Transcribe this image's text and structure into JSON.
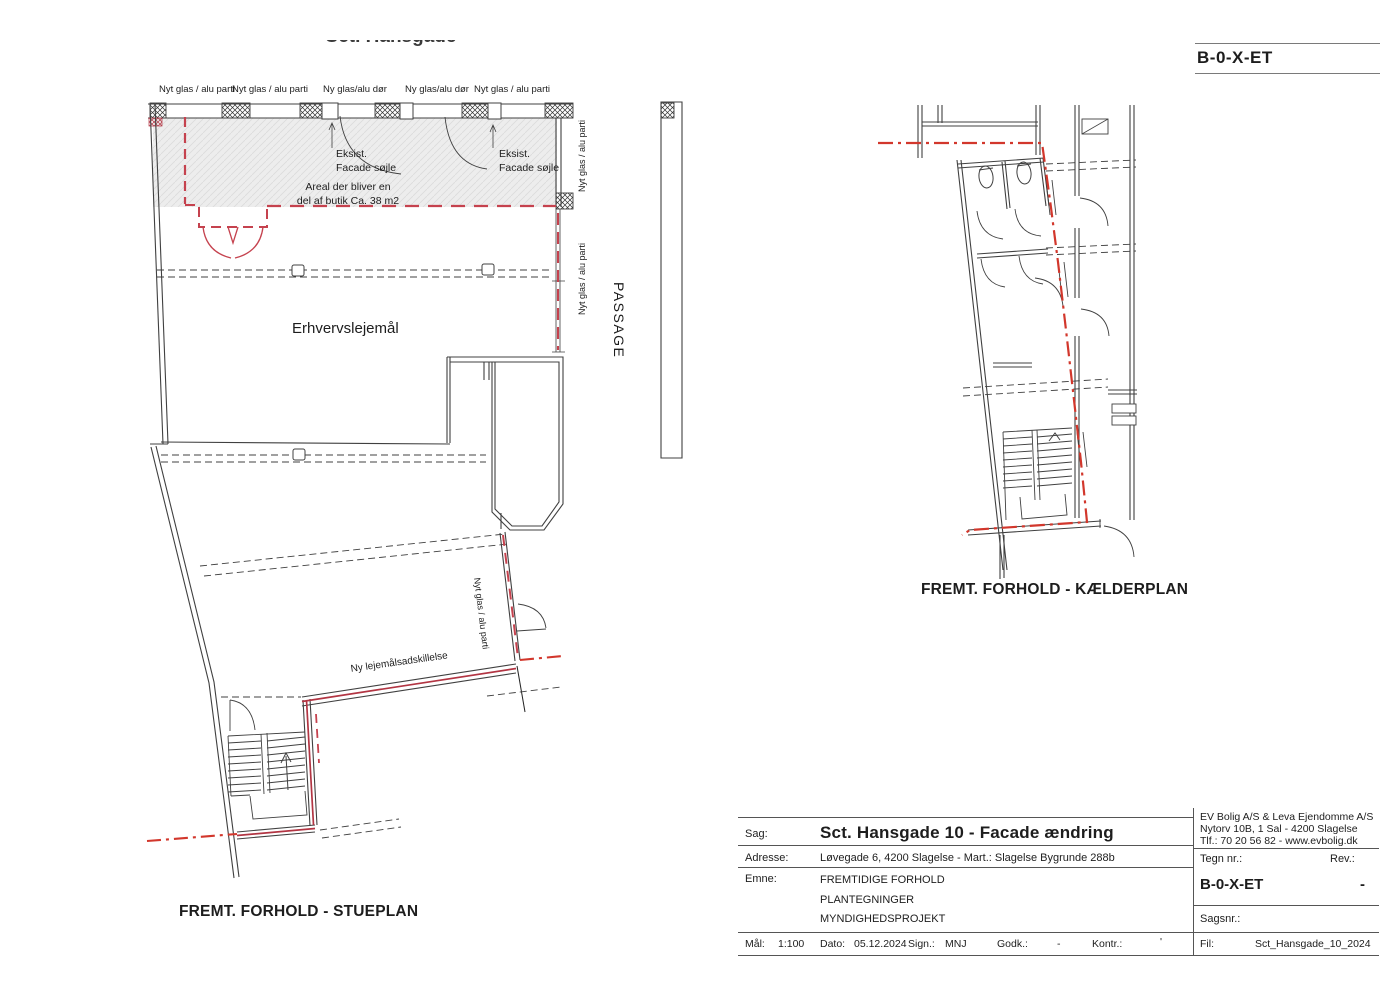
{
  "header": {
    "sheet_code": "B-0-X-ET"
  },
  "stueplan": {
    "title": "FREMT. FORHOLD - STUEPLAN",
    "street_label": "Sct. Hansgade",
    "passage_label": "PASSAGE",
    "facade_labels": [
      "Nyt glas / alu parti",
      "Nyt glas / alu parti",
      "Ny glas/alu dør",
      "Ny glas/alu dør",
      "Nyt glas / alu parti"
    ],
    "existing_column_note": "Eksist.\nFacade søjle",
    "shop_area_note": "Areal der bliver en\ndel af butik Ca. 38 m2",
    "room_label": "Erhvervslejemål",
    "side_glass_label": "Nyt glas / alu parti",
    "tilted_glass_label": "Nyt glas / alu parti",
    "partition_label": "Ny lejemålsadskillelse"
  },
  "kaelderplan": {
    "title": "FREMT. FORHOLD - KÆLDERPLAN"
  },
  "title_block": {
    "company_lines": [
      "EV Bolig A/S & Leva Ejendomme A/S",
      "Nytorv 10B, 1 Sal - 4200 Slagelse",
      "Tlf.: 70 20 56 82 - www.evbolig.dk"
    ],
    "sag_label": "Sag:",
    "sag_value": "Sct. Hansgade 10 - Facade ændring",
    "adresse_label": "Adresse:",
    "adresse_value": "Løvegade 6, 4200 Slagelse - Mart.: Slagelse Bygrunde 288b",
    "emne_label": "Emne:",
    "emne_lines": [
      "FREMTIDIGE FORHOLD",
      "PLANTEGNINGER",
      "MYNDIGHEDSPROJEKT"
    ],
    "tegn_nr_label": "Tegn nr.:",
    "rev_label": "Rev.:",
    "tegn_nr_value": "B-0-X-ET",
    "rev_value": "-",
    "sagsnr_label": "Sagsnr.:",
    "maal_label": "Mål:",
    "maal_value": "1:100",
    "dato_label": "Dato:",
    "dato_value": "05.12.2024",
    "sign_label": "Sign.:",
    "sign_value": "MNJ",
    "godk_label": "Godk.:",
    "godk_value": "-",
    "kontr_label": "Kontr.:",
    "kontr_value": "'",
    "fil_label": "Fil:",
    "fil_value": "Sct_Hansgade_10_2024"
  },
  "colors": {
    "line": "#404040",
    "red_dash": "#c5424e",
    "red_dashdot": "#d2372c",
    "shade": "#ececec"
  }
}
